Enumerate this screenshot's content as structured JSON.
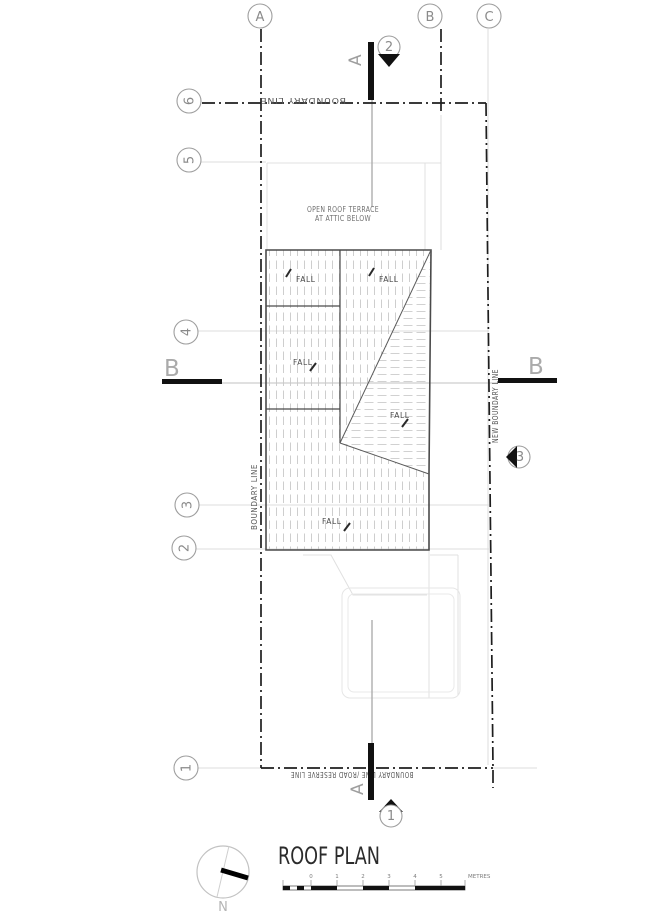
{
  "drawing_title": "ROOF PLAN",
  "grid": {
    "columns": [
      "A",
      "B",
      "C"
    ],
    "rows": [
      "6",
      "5",
      "4",
      "3",
      "2",
      "1"
    ]
  },
  "sections": {
    "top_marker": {
      "number": "2",
      "letter": "A"
    },
    "bottom_marker": {
      "number": "1",
      "letter": "A"
    },
    "side_marker": {
      "number": "3"
    },
    "section_b_left": "B",
    "section_b_right": "B"
  },
  "boundary_labels": {
    "top": "BOUNDARY LINE",
    "bottom": "BOUNDARY LINE /ROAD RESERVE LINE",
    "left": "BOUNDARY LINE",
    "right": "NEW BOUNDARY LINE"
  },
  "roof": {
    "terrace_note_line1": "OPEN ROOF TERRACE",
    "terrace_note_line2": "AT ATTIC BELOW",
    "fall_label": "FALL"
  },
  "compass": {
    "north_label": "N"
  },
  "scale_bar": {
    "tick_labels": [
      "0",
      "1",
      "2",
      "3",
      "4",
      "5"
    ],
    "unit": "METRES"
  },
  "colors": {
    "line_dark": "#4a4a4a",
    "line_black": "#111111",
    "line_gray": "#a8a8a8",
    "line_light": "#dcdcdc",
    "hatch": "#c9c9c9",
    "text_gray": "#8a8a8a"
  }
}
